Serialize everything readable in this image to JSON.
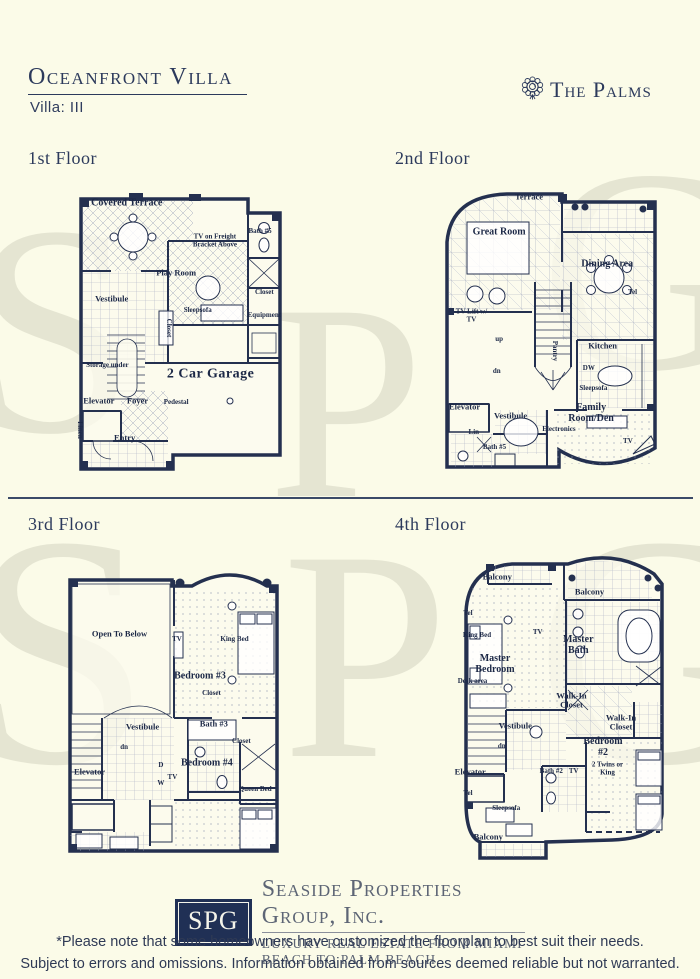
{
  "page": {
    "background": "#fbfbe8",
    "ink": "#24304f",
    "accent": "#2c3a5c"
  },
  "header": {
    "title": "Oceanfront Villa",
    "subtitle": "Villa: III",
    "brand": {
      "name": "The Palms",
      "icon": "rosette-icon"
    }
  },
  "watermark": {
    "letters": [
      "S",
      "P",
      "G",
      "S",
      "P",
      "G"
    ]
  },
  "floors": [
    {
      "title": "1st Floor",
      "rooms": [
        {
          "label": "Covered Terrace",
          "x": 25,
          "y": 7,
          "w": 34
        },
        {
          "label": "Play Room",
          "x": 48,
          "y": 31,
          "size": "sm"
        },
        {
          "label": "TV on Freight Bracket Above",
          "x": 66,
          "y": 20,
          "size": "xs",
          "w": 26
        },
        {
          "label": "Bath #5",
          "x": 87,
          "y": 17,
          "size": "xs",
          "w": 20
        },
        {
          "label": "Closet",
          "x": 89,
          "y": 38,
          "size": "xs"
        },
        {
          "label": "Equipment",
          "x": 89,
          "y": 46,
          "size": "xs"
        },
        {
          "label": "Vestibule",
          "x": 18,
          "y": 40,
          "size": "sm"
        },
        {
          "label": "Closet",
          "x": 44,
          "y": 50,
          "size": "xs",
          "rot": 90
        },
        {
          "label": "Sleepsofa",
          "x": 58,
          "y": 44,
          "size": "xs"
        },
        {
          "label": "2 Car Garage",
          "x": 64,
          "y": 66,
          "size": "lg",
          "bold": true
        },
        {
          "label": "Storage under",
          "x": 16,
          "y": 63,
          "size": "xs",
          "w": 22
        },
        {
          "label": "Elevator",
          "x": 12,
          "y": 75,
          "size": "sm"
        },
        {
          "label": "Foyer",
          "x": 30,
          "y": 75,
          "size": "sm"
        },
        {
          "label": "Pedestal",
          "x": 48,
          "y": 76,
          "size": "xs"
        },
        {
          "label": "Entry",
          "x": 24,
          "y": 88,
          "size": "sm"
        },
        {
          "label": "Linen",
          "x": 3,
          "y": 85,
          "size": "xs",
          "rot": 90
        }
      ]
    },
    {
      "title": "2nd Floor",
      "rooms": [
        {
          "label": "Terrace",
          "x": 40,
          "y": 5,
          "size": "sm"
        },
        {
          "label": "Great Room",
          "x": 27,
          "y": 17,
          "w": 28
        },
        {
          "label": "Dining Area",
          "x": 74,
          "y": 28,
          "w": 24
        },
        {
          "label": "Tel",
          "x": 85,
          "y": 38,
          "size": "xs"
        },
        {
          "label": "TV Lift w/ TV",
          "x": 15,
          "y": 46,
          "size": "xs",
          "w": 18
        },
        {
          "label": "up",
          "x": 27,
          "y": 54,
          "size": "xs"
        },
        {
          "label": "dn",
          "x": 26,
          "y": 65,
          "size": "xs"
        },
        {
          "label": "Pantry",
          "x": 51,
          "y": 58,
          "size": "xs",
          "rot": 90
        },
        {
          "label": "Kitchen",
          "x": 72,
          "y": 56,
          "size": "sm"
        },
        {
          "label": "DW",
          "x": 66,
          "y": 64,
          "size": "xs"
        },
        {
          "label": "Sleepsofa",
          "x": 68,
          "y": 71,
          "size": "xs"
        },
        {
          "label": "Family Room/Den",
          "x": 67,
          "y": 79,
          "w": 28
        },
        {
          "label": "Electronics",
          "x": 53,
          "y": 85,
          "size": "xs"
        },
        {
          "label": "TV",
          "x": 83,
          "y": 89,
          "size": "xs"
        },
        {
          "label": "Elevator",
          "x": 12,
          "y": 77,
          "size": "sm"
        },
        {
          "label": "Vestibule",
          "x": 32,
          "y": 80,
          "size": "sm"
        },
        {
          "label": "Lin",
          "x": 16,
          "y": 86,
          "size": "xs"
        },
        {
          "label": "Bath #5",
          "x": 25,
          "y": 91,
          "size": "xs"
        }
      ]
    },
    {
      "title": "3rd Floor",
      "rooms": [
        {
          "label": "Open To Below",
          "x": 25,
          "y": 26,
          "w": 26,
          "size": "sm"
        },
        {
          "label": "TV",
          "x": 50,
          "y": 28,
          "size": "xs"
        },
        {
          "label": "King Bed",
          "x": 75,
          "y": 28,
          "size": "xs",
          "w": 14
        },
        {
          "label": "Bedroom #3",
          "x": 60,
          "y": 40,
          "w": 24
        },
        {
          "label": "Closet",
          "x": 65,
          "y": 46,
          "size": "xs"
        },
        {
          "label": "Bath #3",
          "x": 66,
          "y": 56,
          "size": "sm"
        },
        {
          "label": "Closet",
          "x": 78,
          "y": 62,
          "size": "xs"
        },
        {
          "label": "Vestibule",
          "x": 35,
          "y": 57,
          "size": "sm"
        },
        {
          "label": "dn",
          "x": 27,
          "y": 64,
          "size": "xs"
        },
        {
          "label": "Elevator",
          "x": 12,
          "y": 72,
          "size": "sm"
        },
        {
          "label": "D",
          "x": 43,
          "y": 70,
          "size": "xs"
        },
        {
          "label": "W",
          "x": 43,
          "y": 76,
          "size": "xs"
        },
        {
          "label": "Bedroom #4",
          "x": 63,
          "y": 69,
          "w": 24
        },
        {
          "label": "TV",
          "x": 48,
          "y": 74,
          "size": "xs"
        },
        {
          "label": "Queen Bed",
          "x": 84,
          "y": 78,
          "size": "xs",
          "w": 16
        }
      ]
    },
    {
      "title": "4th Floor",
      "rooms": [
        {
          "label": "Balcony",
          "x": 21,
          "y": 8,
          "size": "sm"
        },
        {
          "label": "Balcony",
          "x": 62,
          "y": 13,
          "size": "sm"
        },
        {
          "label": "Tel",
          "x": 8,
          "y": 20,
          "size": "xs"
        },
        {
          "label": "King Bed",
          "x": 12,
          "y": 27,
          "size": "xs",
          "w": 13
        },
        {
          "label": "TV",
          "x": 39,
          "y": 26,
          "size": "xs"
        },
        {
          "label": "Master Bath",
          "x": 57,
          "y": 30,
          "w": 20
        },
        {
          "label": "Master Bedroom",
          "x": 20,
          "y": 36,
          "w": 26
        },
        {
          "label": "Desk area",
          "x": 10,
          "y": 42,
          "size": "xs",
          "w": 16
        },
        {
          "label": "Walk-In Closet",
          "x": 54,
          "y": 48,
          "w": 20,
          "size": "sm"
        },
        {
          "label": "Walk-In Closet",
          "x": 76,
          "y": 55,
          "w": 18,
          "size": "sm"
        },
        {
          "label": "Vestibule",
          "x": 29,
          "y": 56,
          "size": "sm"
        },
        {
          "label": "dn",
          "x": 23,
          "y": 63,
          "size": "xs"
        },
        {
          "label": "Elevator",
          "x": 9,
          "y": 71,
          "size": "sm"
        },
        {
          "label": "Bath #2",
          "x": 45,
          "y": 71,
          "size": "xs",
          "w": 13
        },
        {
          "label": "TV",
          "x": 55,
          "y": 71,
          "size": "xs"
        },
        {
          "label": "Bedroom #2",
          "x": 68,
          "y": 63,
          "w": 22
        },
        {
          "label": "2 Twins or King",
          "x": 70,
          "y": 70,
          "size": "xs",
          "w": 18
        },
        {
          "label": "Tel",
          "x": 8,
          "y": 78,
          "size": "xs"
        },
        {
          "label": "Sleepsofa",
          "x": 25,
          "y": 83,
          "size": "xs"
        },
        {
          "label": "Balcony",
          "x": 17,
          "y": 92,
          "size": "sm"
        }
      ]
    }
  ],
  "footer": {
    "logo_text": "SPG",
    "company": "Seaside Properties Group, Inc.",
    "tagline": "LUXURY REAL ESTATE FROM MIAMI BEACH TO PALM BEACH",
    "disclaimer_line1": "*Please note that some homeowners have customized the floorplan to best suit their needs.",
    "disclaimer_line2": "Subject to errors and omissions. Information obtained from sources deemed reliable but not warranted."
  }
}
